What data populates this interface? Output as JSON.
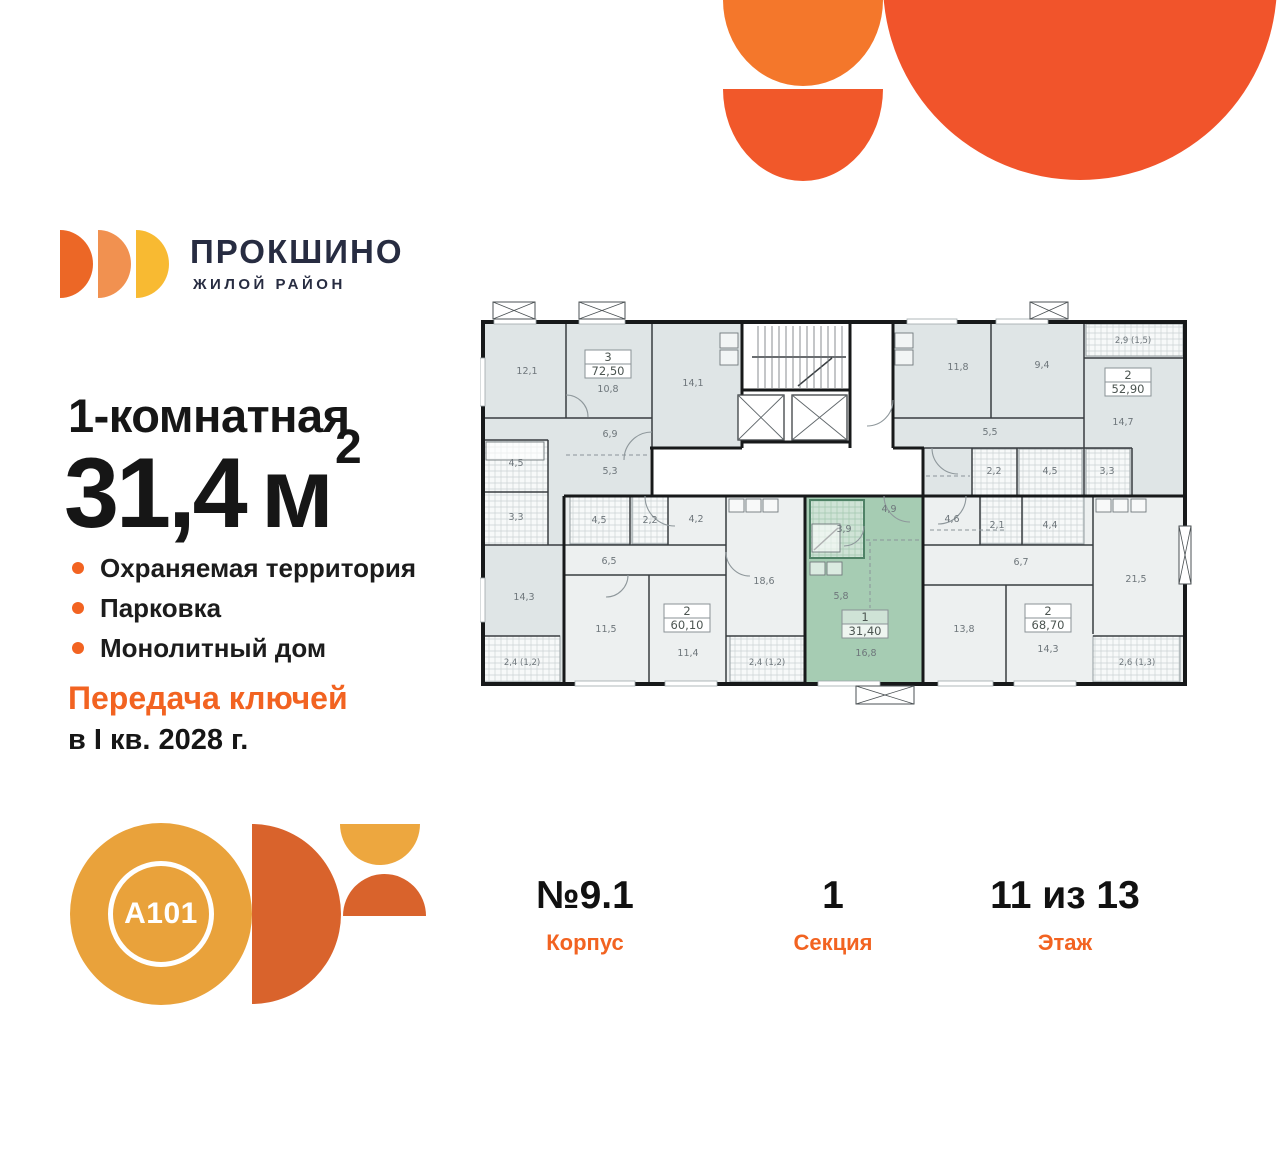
{
  "brand": {
    "name": "ПРОКШИНО",
    "tagline": "ЖИЛОЙ РАЙОН"
  },
  "listing": {
    "rooms_line": "1-комнатная",
    "area_value": "31,4",
    "area_unit": "м",
    "area_sup": "2",
    "features": [
      "Охраняемая территория",
      "Парковка",
      "Монолитный дом"
    ],
    "handover_line1": "Передача ключей",
    "handover_line2": "в I кв. 2028 г."
  },
  "developer": {
    "logo_text": "A101"
  },
  "footer": {
    "items": [
      {
        "value": "№9.1",
        "label": "Корпус"
      },
      {
        "value": "1",
        "label": "Секция"
      },
      {
        "value": "11 из 13",
        "label": "Этаж"
      }
    ]
  },
  "colors": {
    "accent": "#f26321",
    "brand_navy": "#272c41",
    "decor_orange": "#f1542b",
    "petal_orange": "#ec6726",
    "petal_light": "#f19150",
    "petal_yellow": "#f8ba32",
    "a101_gold": "#e9a23b",
    "a101_rust": "#d9632c",
    "plan_highlight": "#a6ccb3",
    "plan_room_gray": "#dfe5e6",
    "plan_room_light": "#edf0f0"
  },
  "floorplan": {
    "highlight_apartment": {
      "number": "1",
      "area": "31,40",
      "rooms": [
        "4,9",
        "3,9",
        "5,8",
        "16,8"
      ]
    },
    "palette": {
      "gray": "#dfe5e6",
      "light": "#edf0f0",
      "green": "#a6ccb3",
      "white": "#ffffff"
    },
    "zones": [
      {
        "p": "3,22 262,22 262,148 172,148 172,196 84,196 84,384 3,384",
        "f": "gray"
      },
      {
        "p": "413,22 705,22 705,196 444,196 444,148 413,148",
        "f": "gray"
      },
      {
        "r": [
          262,
          22,
          151,
          126
        ],
        "f": "white"
      },
      {
        "r": [
          170,
          148,
          274,
          48
        ],
        "f": "white"
      },
      {
        "r": [
          84,
          196,
          241,
          188
        ],
        "f": "light"
      },
      {
        "r": [
          326,
          196,
          117,
          188
        ],
        "f": "green"
      },
      {
        "r": [
          444,
          196,
          261,
          188
        ],
        "f": "light"
      }
    ],
    "hatched": [
      [
        4,
        336,
        76,
        46
      ],
      [
        250,
        336,
        74,
        46
      ],
      [
        613,
        336,
        87,
        46
      ],
      [
        606,
        24,
        97,
        32
      ],
      [
        4,
        140,
        64,
        52
      ],
      [
        4,
        192,
        64,
        53
      ],
      [
        90,
        197,
        60,
        47
      ],
      [
        152,
        197,
        36,
        47
      ],
      [
        492,
        149,
        45,
        46
      ],
      [
        539,
        149,
        63,
        46
      ],
      [
        606,
        149,
        44,
        46
      ],
      [
        500,
        197,
        42,
        47
      ],
      [
        542,
        197,
        62,
        47
      ]
    ],
    "green_bath": [
      330,
      200,
      54,
      58
    ],
    "perimeter": [
      3,
      22,
      702,
      362
    ],
    "walls_thick": [
      [
        262,
        22,
        262,
        148
      ],
      [
        413,
        22,
        413,
        148
      ],
      [
        370,
        22,
        370,
        148
      ],
      [
        262,
        90,
        370,
        90
      ],
      [
        262,
        142,
        370,
        142
      ],
      [
        170,
        148,
        262,
        148
      ],
      [
        413,
        148,
        444,
        148
      ],
      [
        84,
        196,
        444,
        196
      ],
      [
        444,
        196,
        705,
        196
      ],
      [
        84,
        196,
        84,
        384
      ],
      [
        172,
        148,
        172,
        196
      ],
      [
        325,
        196,
        325,
        384
      ],
      [
        443,
        148,
        443,
        384
      ]
    ],
    "walls_thin": [
      [
        86,
        22,
        86,
        118
      ],
      [
        3,
        118,
        172,
        118
      ],
      [
        172,
        22,
        172,
        148
      ],
      [
        3,
        140,
        68,
        140
      ],
      [
        3,
        192,
        68,
        192
      ],
      [
        68,
        140,
        68,
        245
      ],
      [
        3,
        245,
        84,
        245
      ],
      [
        3,
        336,
        80,
        336
      ],
      [
        84,
        245,
        246,
        245
      ],
      [
        84,
        275,
        246,
        275
      ],
      [
        150,
        196,
        150,
        245
      ],
      [
        188,
        196,
        188,
        245
      ],
      [
        246,
        196,
        246,
        384
      ],
      [
        169,
        275,
        169,
        384
      ],
      [
        246,
        336,
        324,
        336
      ],
      [
        444,
        245,
        613,
        245
      ],
      [
        444,
        285,
        613,
        285
      ],
      [
        500,
        196,
        500,
        245
      ],
      [
        542,
        196,
        542,
        245
      ],
      [
        613,
        196,
        613,
        334
      ],
      [
        526,
        285,
        526,
        384
      ],
      [
        613,
        336,
        705,
        336
      ],
      [
        511,
        22,
        511,
        118
      ],
      [
        413,
        118,
        604,
        118
      ],
      [
        604,
        22,
        604,
        196
      ],
      [
        604,
        58,
        705,
        58
      ],
      [
        444,
        148,
        652,
        148
      ],
      [
        492,
        148,
        492,
        196
      ],
      [
        537,
        148,
        537,
        196
      ],
      [
        652,
        148,
        652,
        196
      ],
      [
        272,
        57,
        366,
        57
      ],
      [
        318,
        86,
        352,
        58
      ],
      [
        334,
        250,
        358,
        228
      ]
    ],
    "dashes": [
      [
        86,
        155,
        170,
        155
      ],
      [
        386,
        240,
        443,
        240
      ],
      [
        390,
        242,
        390,
        308
      ],
      [
        450,
        230,
        524,
        230
      ],
      [
        446,
        176,
        490,
        176
      ]
    ],
    "windows": [
      [
        14,
        19,
        42,
        5
      ],
      [
        99,
        19,
        46,
        5
      ],
      [
        427,
        19,
        50,
        5
      ],
      [
        516,
        19,
        52,
        5
      ],
      [
        95,
        381,
        60,
        5
      ],
      [
        185,
        381,
        52,
        5
      ],
      [
        338,
        381,
        62,
        5
      ],
      [
        458,
        381,
        55,
        5
      ],
      [
        534,
        381,
        62,
        5
      ],
      [
        0,
        58,
        5,
        48
      ],
      [
        0,
        278,
        5,
        44
      ]
    ],
    "fixtures": [
      [
        240,
        33,
        18,
        15
      ],
      [
        240,
        50,
        18,
        15
      ],
      [
        415,
        33,
        18,
        15
      ],
      [
        415,
        50,
        18,
        15
      ],
      [
        249,
        199,
        15,
        13
      ],
      [
        266,
        199,
        15,
        13
      ],
      [
        283,
        199,
        15,
        13
      ],
      [
        616,
        199,
        15,
        13
      ],
      [
        633,
        199,
        15,
        13
      ],
      [
        651,
        199,
        15,
        13
      ],
      [
        330,
        262,
        15,
        13
      ],
      [
        347,
        262,
        15,
        13
      ],
      [
        332,
        224,
        28,
        28
      ],
      [
        6,
        142,
        58,
        18
      ]
    ],
    "elevators": [
      [
        258,
        95,
        46,
        45
      ],
      [
        312,
        95,
        55,
        45
      ]
    ],
    "stairs": [
      272,
      26,
      94,
      62
    ],
    "xboxes": [
      [
        13,
        2,
        42,
        17
      ],
      [
        99,
        2,
        46,
        17
      ],
      [
        550,
        2,
        38,
        17
      ],
      [
        376,
        386,
        58,
        18
      ],
      [
        699,
        226,
        12,
        58
      ]
    ],
    "arcs": [
      "M165,196 A30,30 0 0 0 195,226",
      "M404,196 A26,26 0 0 0 430,222",
      "M486,196 A28,28 0 0 1 458,224",
      "M452,148 A26,26 0 0 0 478,174",
      "M172,132 A28,28 0 0 0 144,160",
      "M86,95 A22,22 0 0 1 108,117",
      "M246,252 A24,24 0 0 0 270,276",
      "M148,275 A22,22 0 0 1 126,297",
      "M384,226 A20,20 0 0 1 364,246",
      "M413,100 A26,26 0 0 1 387,126"
    ],
    "labels": [
      [
        "12,1",
        47,
        74
      ],
      [
        "10,8",
        128,
        92
      ],
      [
        "14,1",
        213,
        86
      ],
      [
        "6,9",
        130,
        137
      ],
      [
        "5,3",
        130,
        174
      ],
      [
        "4,5",
        36,
        166
      ],
      [
        "3,3",
        36,
        220
      ],
      [
        "14,3",
        44,
        300
      ],
      [
        "2,4 (1,2)",
        42,
        365,
        8.5
      ],
      [
        "4,5",
        119,
        223
      ],
      [
        "2,2",
        170,
        223
      ],
      [
        "4,2",
        216,
        222
      ],
      [
        "6,5",
        129,
        264
      ],
      [
        "11,5",
        126,
        332
      ],
      [
        "11,4",
        208,
        356
      ],
      [
        "18,6",
        284,
        284
      ],
      [
        "2,4 (1,2)",
        287,
        365,
        8.5
      ],
      [
        "4,9",
        409,
        212
      ],
      [
        "3,9",
        364,
        232
      ],
      [
        "5,8",
        361,
        299
      ],
      [
        "16,8",
        386,
        356
      ],
      [
        "4,6",
        472,
        222
      ],
      [
        "2,1",
        517,
        228
      ],
      [
        "4,4",
        570,
        228
      ],
      [
        "6,7",
        541,
        265
      ],
      [
        "13,8",
        484,
        332
      ],
      [
        "14,3",
        568,
        352
      ],
      [
        "21,5",
        656,
        282
      ],
      [
        "2,6 (1,3)",
        657,
        365,
        8.5
      ],
      [
        "11,8",
        478,
        70
      ],
      [
        "9,4",
        562,
        68
      ],
      [
        "5,5",
        510,
        135
      ],
      [
        "2,2",
        514,
        174
      ],
      [
        "4,5",
        570,
        174
      ],
      [
        "3,3",
        627,
        174
      ],
      [
        "14,7",
        643,
        125
      ],
      [
        "2,9 (1,5)",
        653,
        43,
        8.5
      ]
    ],
    "apt_boxes": [
      {
        "x": 105,
        "y": 50,
        "num": "3",
        "area": "72,50"
      },
      {
        "x": 184,
        "y": 304,
        "num": "2",
        "area": "60,10"
      },
      {
        "x": 362,
        "y": 310,
        "num": "1",
        "area": "31,40",
        "g": true
      },
      {
        "x": 545,
        "y": 304,
        "num": "2",
        "area": "68,70"
      },
      {
        "x": 625,
        "y": 68,
        "num": "2",
        "area": "52,90"
      }
    ]
  }
}
